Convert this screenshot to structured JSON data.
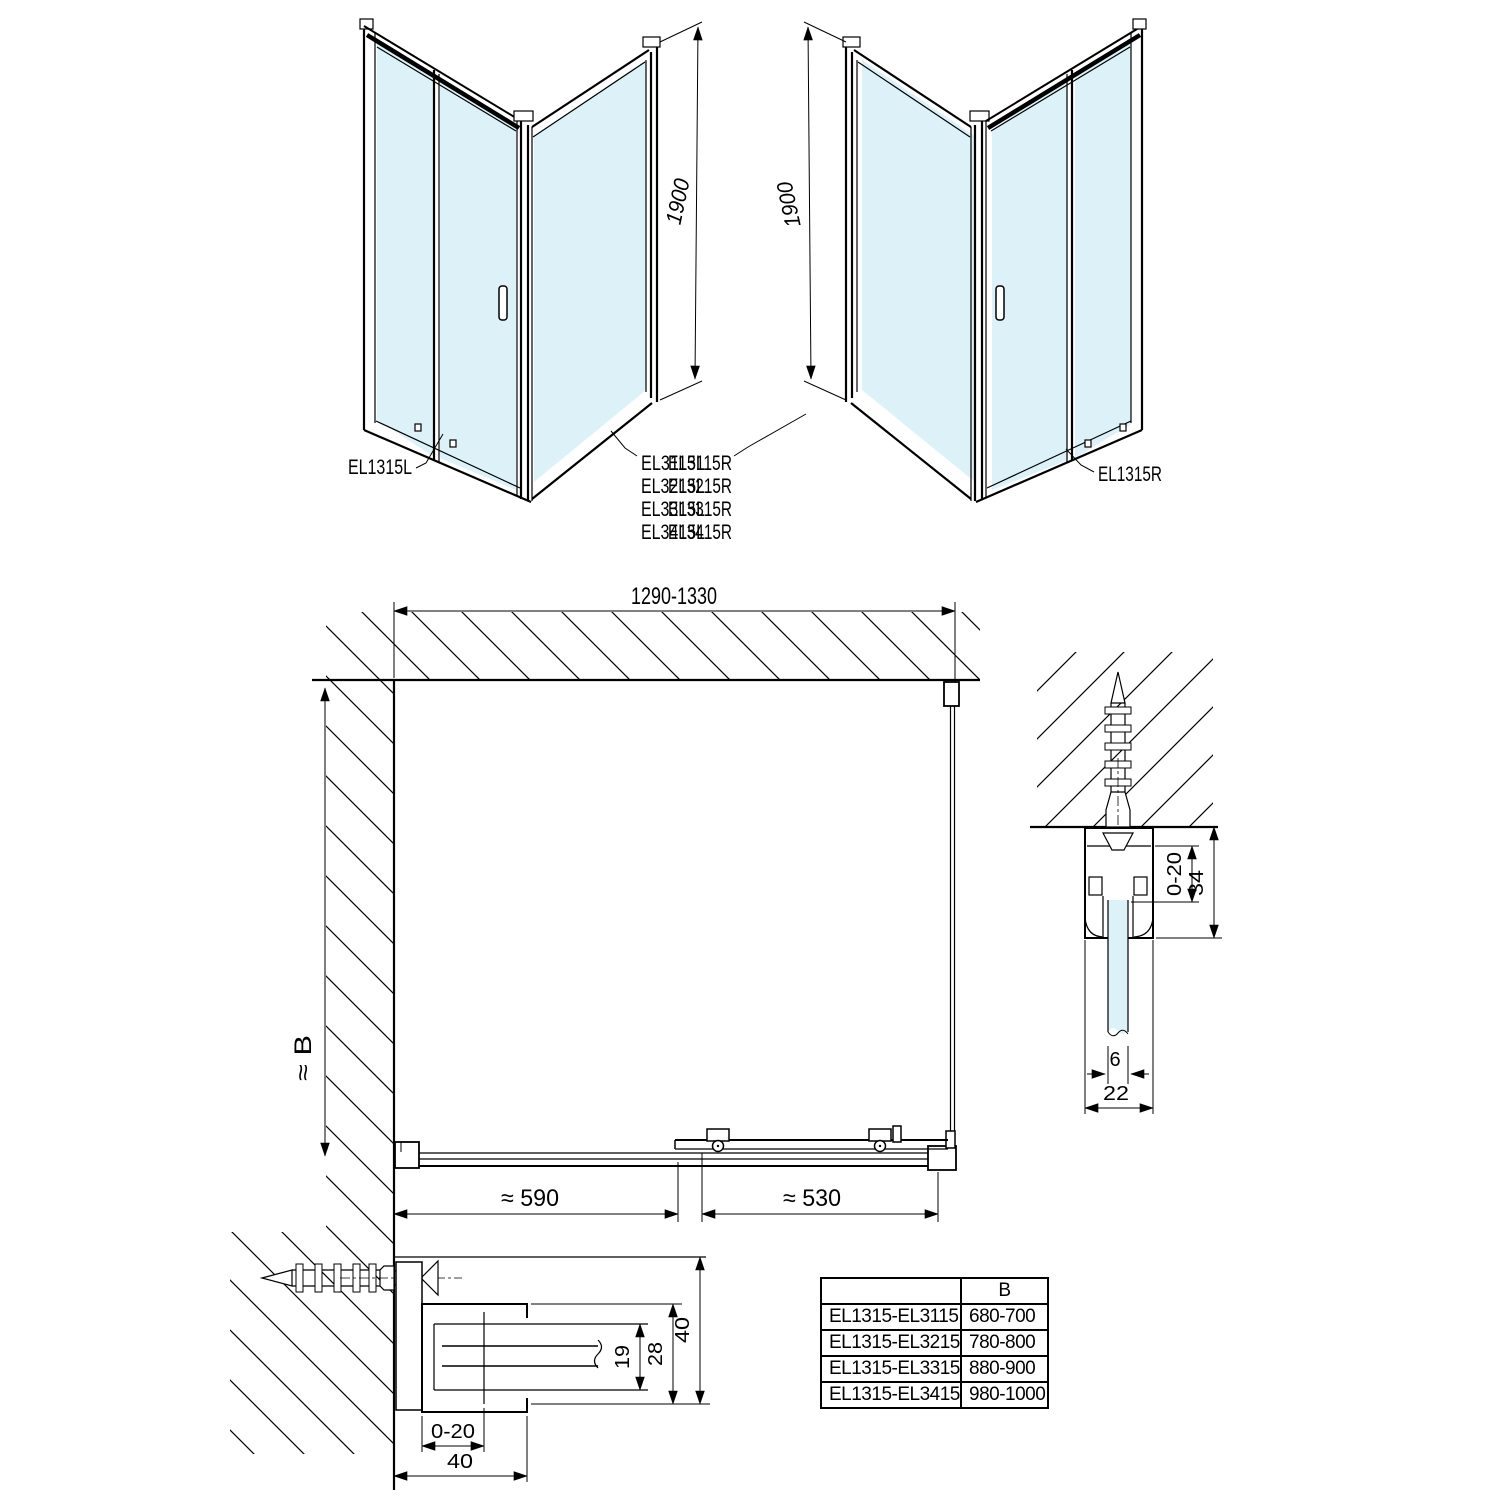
{
  "views": {
    "iso_left": {
      "height_dim": "1900",
      "door_label": "EL1315L",
      "panel_labels": [
        "EL3115L",
        "EL3215L",
        "EL3315L",
        "EL3415L"
      ]
    },
    "iso_right": {
      "height_dim": "1900",
      "door_label": "EL1315R",
      "panel_labels": [
        "EL3115R",
        "EL3215R",
        "EL3315R",
        "EL3415R"
      ]
    },
    "plan": {
      "width_dim": "1290-1330",
      "depth_dim": "≈ B",
      "fixed_part_dim": "≈ 590",
      "sliding_part_dim": "≈ 530"
    },
    "detail_side_profile": {
      "adjust_dim": "0-20",
      "depth_dim": "34",
      "glass_dim": "6",
      "profile_width_dim": "22"
    },
    "detail_bottom_profile": {
      "adjust_dim": "0-20",
      "profile_width_dim": "40",
      "glass_pocket_dim": "19",
      "pocket_outer_dim": "28",
      "profile_depth_dim": "40"
    }
  },
  "size_table": {
    "headers": [
      "",
      "B"
    ],
    "rows": [
      [
        "EL1315-EL3115",
        "680-700"
      ],
      [
        "EL1315-EL3215",
        "780-800"
      ],
      [
        "EL1315-EL3315",
        "880-900"
      ],
      [
        "EL1315-EL3415",
        "980-1000"
      ]
    ]
  },
  "colors": {
    "glass": "#dcf2f8",
    "line": "#000000"
  }
}
